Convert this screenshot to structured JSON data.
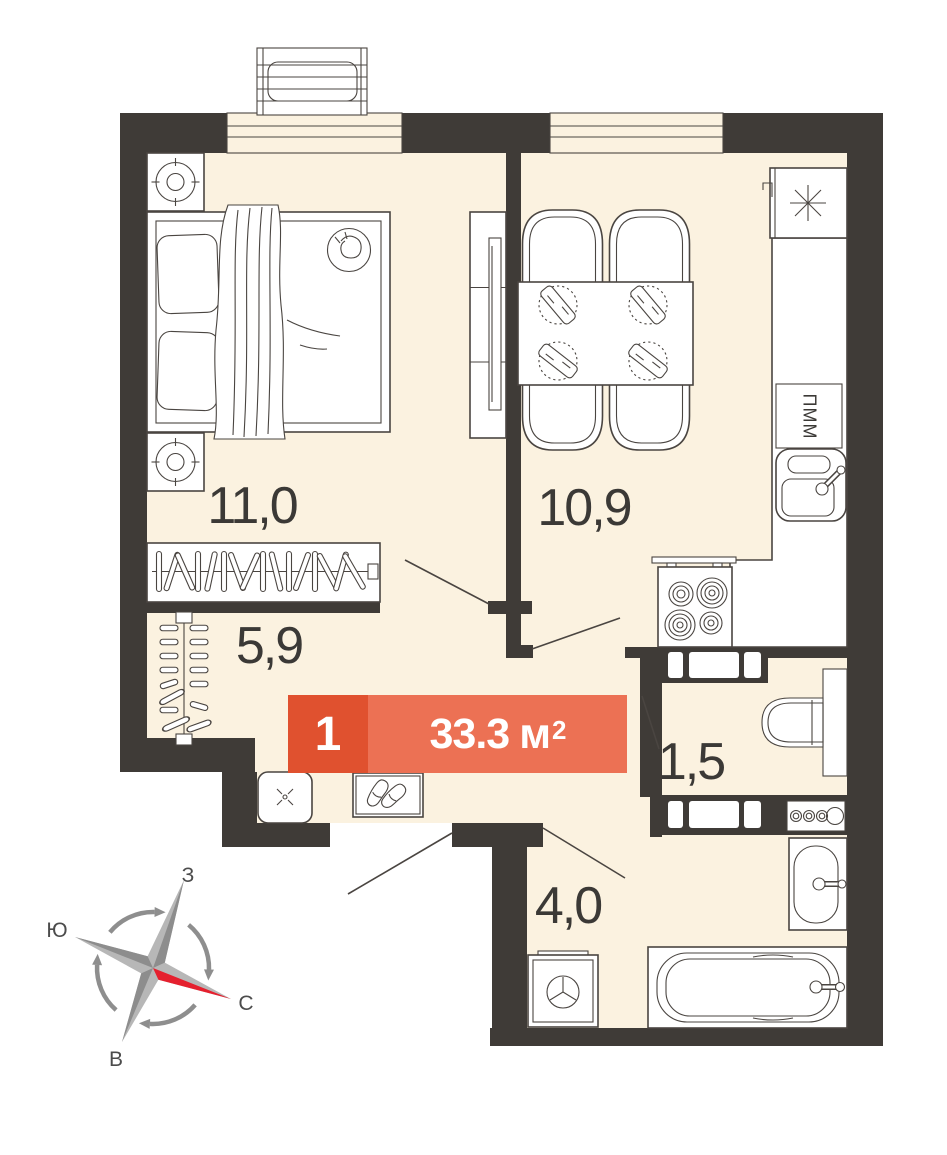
{
  "badge": {
    "rooms": "1",
    "area": "33.3",
    "unit": "м",
    "sup": "2"
  },
  "rooms": {
    "living": {
      "area": "11,0"
    },
    "kitchen": {
      "area": "10,9"
    },
    "hall": {
      "area": "5,9"
    },
    "wc": {
      "area": "1,5"
    },
    "bath": {
      "area": "4,0"
    }
  },
  "appliances": {
    "dishwasher": "ПММ"
  },
  "compass": {
    "top": "З",
    "left": "Ю",
    "right": "С",
    "bottom": "В"
  },
  "colors": {
    "wall": "#3f3b37",
    "floor": "#fbf2e0",
    "line": "#4a4541",
    "badge_dark": "#e0512f",
    "badge_light": "#ec7154",
    "compass_red": "#e5202e",
    "text": "#3b3936"
  }
}
